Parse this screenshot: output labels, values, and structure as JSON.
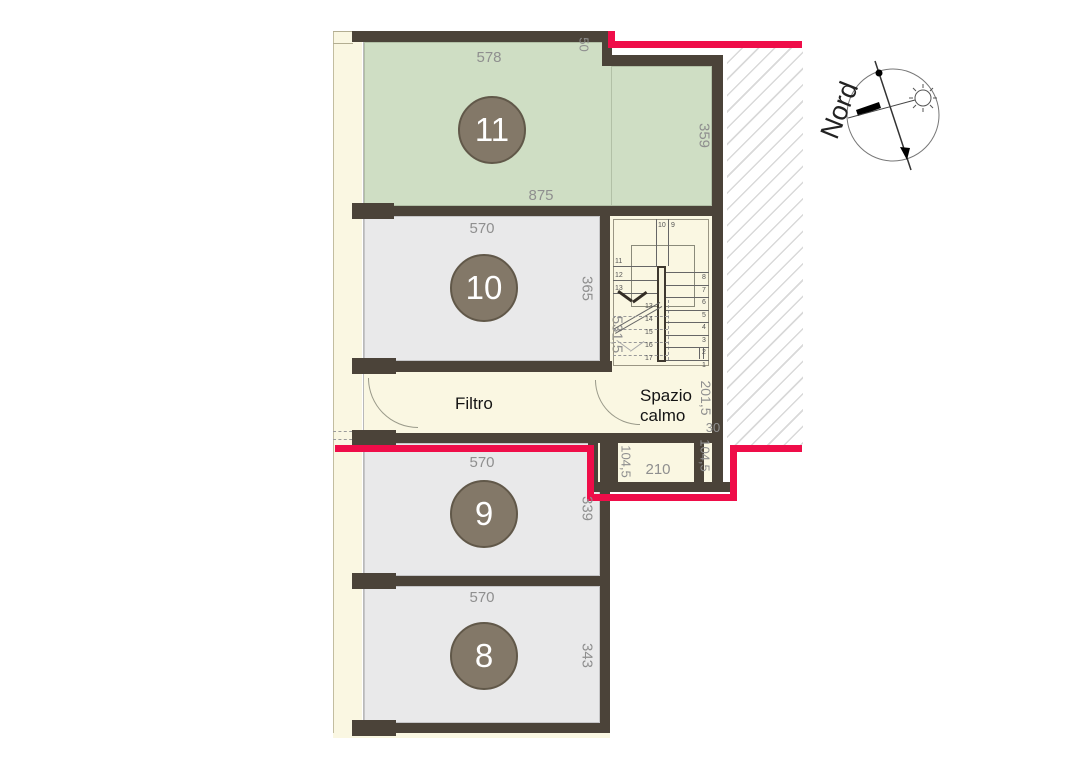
{
  "palette": {
    "wall": "#4b4339",
    "room_green": "#cfdec4",
    "room_gray": "#e9e9ea",
    "corridor_cream": "#faf7e2",
    "escape_route_red": "#ef0d49",
    "dimension_text": "#8f8f8f",
    "room_badge": "#837868",
    "hatch_line": "#d9d9d9"
  },
  "rooms": {
    "r11": {
      "number": "11",
      "dim_top": "578",
      "dim_notch": "50",
      "dim_right": "359",
      "dim_bottom": "875"
    },
    "r10": {
      "number": "10",
      "dim_top": "570",
      "dim_right": "365"
    },
    "r9": {
      "number": "9",
      "dim_top": "570",
      "dim_right": "339"
    },
    "r8": {
      "number": "8",
      "dim_top": "570",
      "dim_right": "343"
    }
  },
  "corridor": {
    "label": "Filtro"
  },
  "safe_area": {
    "label_line1": "Spazio",
    "label_line2": "calmo",
    "dim_right": "201,5",
    "dim_jog": "30",
    "dim_left_shaft": "104,5",
    "dim_opening": "210",
    "dim_right_shaft": "104,5"
  },
  "stair": {
    "dim_flight": "531,5",
    "top_steps": [
      "10",
      "9"
    ],
    "upper_steps": [
      "11",
      "12",
      "13"
    ],
    "hidden_steps": [
      "13",
      "14",
      "15",
      "16",
      "17"
    ],
    "lower_steps": [
      "8",
      "7",
      "6",
      "5",
      "4",
      "3",
      "2",
      "1"
    ]
  },
  "compass": {
    "label": "Nord"
  }
}
